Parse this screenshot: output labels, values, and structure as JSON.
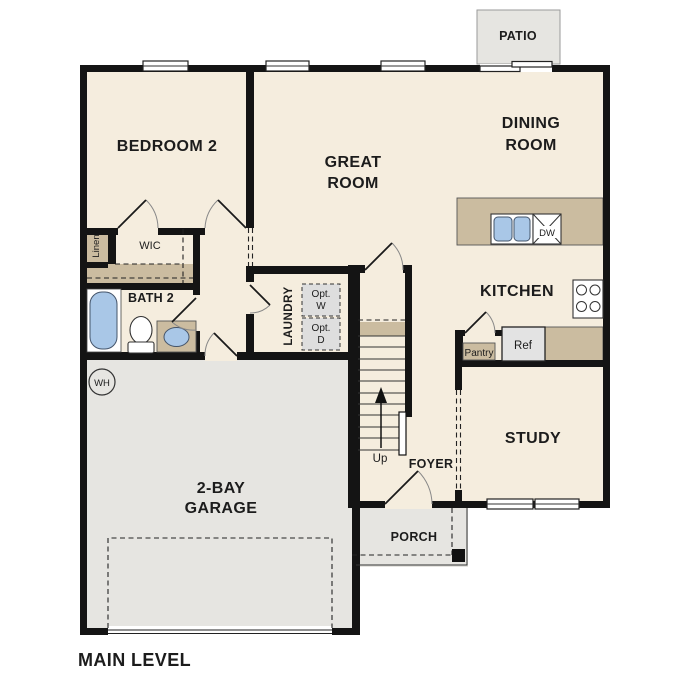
{
  "plan": {
    "level_label": "MAIN LEVEL"
  },
  "rooms": {
    "bedroom2": "BEDROOM 2",
    "great_room": [
      "GREAT",
      "ROOM"
    ],
    "dining_room": [
      "DINING",
      "ROOM"
    ],
    "kitchen": "KITCHEN",
    "bath2": "BATH 2",
    "wic": "WIC",
    "linen": "Linen",
    "laundry": "LAUNDRY",
    "study": "STUDY",
    "foyer": "FOYER",
    "porch": "PORCH",
    "patio": "PATIO",
    "garage": [
      "2-BAY",
      "GARAGE"
    ]
  },
  "fixtures": {
    "washer_opt": [
      "Opt.",
      "W"
    ],
    "dryer_opt": [
      "Opt.",
      "D"
    ],
    "dishwasher": "DW",
    "refrigerator": "Ref",
    "pantry": "Pantry",
    "water_heater": "WH",
    "stairs_direction": "Up"
  },
  "colors": {
    "floor": "#f5edde",
    "counter_tan": "#cbbca0",
    "concrete_gray": "#e6e5e1",
    "fixture_blue": "#a9c7e7",
    "wall_black": "#141414",
    "appliance_gray": "#e3e3e3",
    "option_box_gray": "#dedede",
    "text": "#1c1c1c"
  }
}
